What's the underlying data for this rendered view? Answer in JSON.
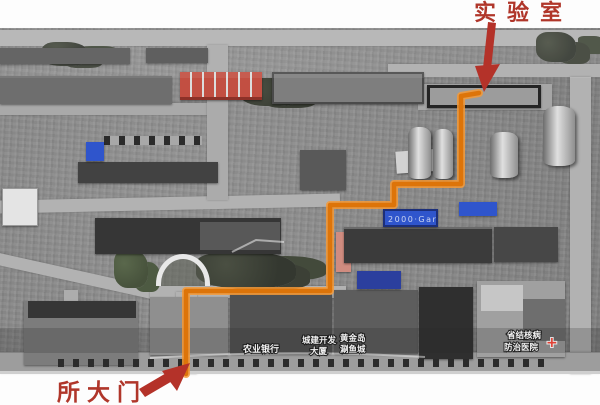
{
  "annotations": {
    "lab_label": "实验室",
    "gate_label": "所大门"
  },
  "map_labels": {
    "bank": "农业银行",
    "dev_line1": "城建开发",
    "dev_line2": "大厦",
    "shop_line1": "黄金岛",
    "shop_line2": "涮鱼城",
    "hospital_line1": "省结核病",
    "hospital_line2": "防治医院",
    "hospital_cross": "+",
    "roof_sign": "2000·Gar"
  },
  "route": {
    "points": [
      [
        186,
        374
      ],
      [
        186,
        291
      ],
      [
        330,
        291
      ],
      [
        330,
        205
      ],
      [
        394,
        205
      ],
      [
        394,
        184
      ],
      [
        461,
        184
      ],
      [
        461,
        96
      ],
      [
        479,
        93
      ]
    ]
  },
  "colors": {
    "route_core": "#dd7409",
    "route_glow": "#f59a38",
    "annotation_red": "#b0362a",
    "arrow_red": "#b43229",
    "red_roof": "#c24f42",
    "blue_roof": "#2f55cc",
    "blue_roof_dark": "#2b3f9e",
    "hospital_cross_red": "#e04034",
    "pink_building": "#d08c80"
  }
}
